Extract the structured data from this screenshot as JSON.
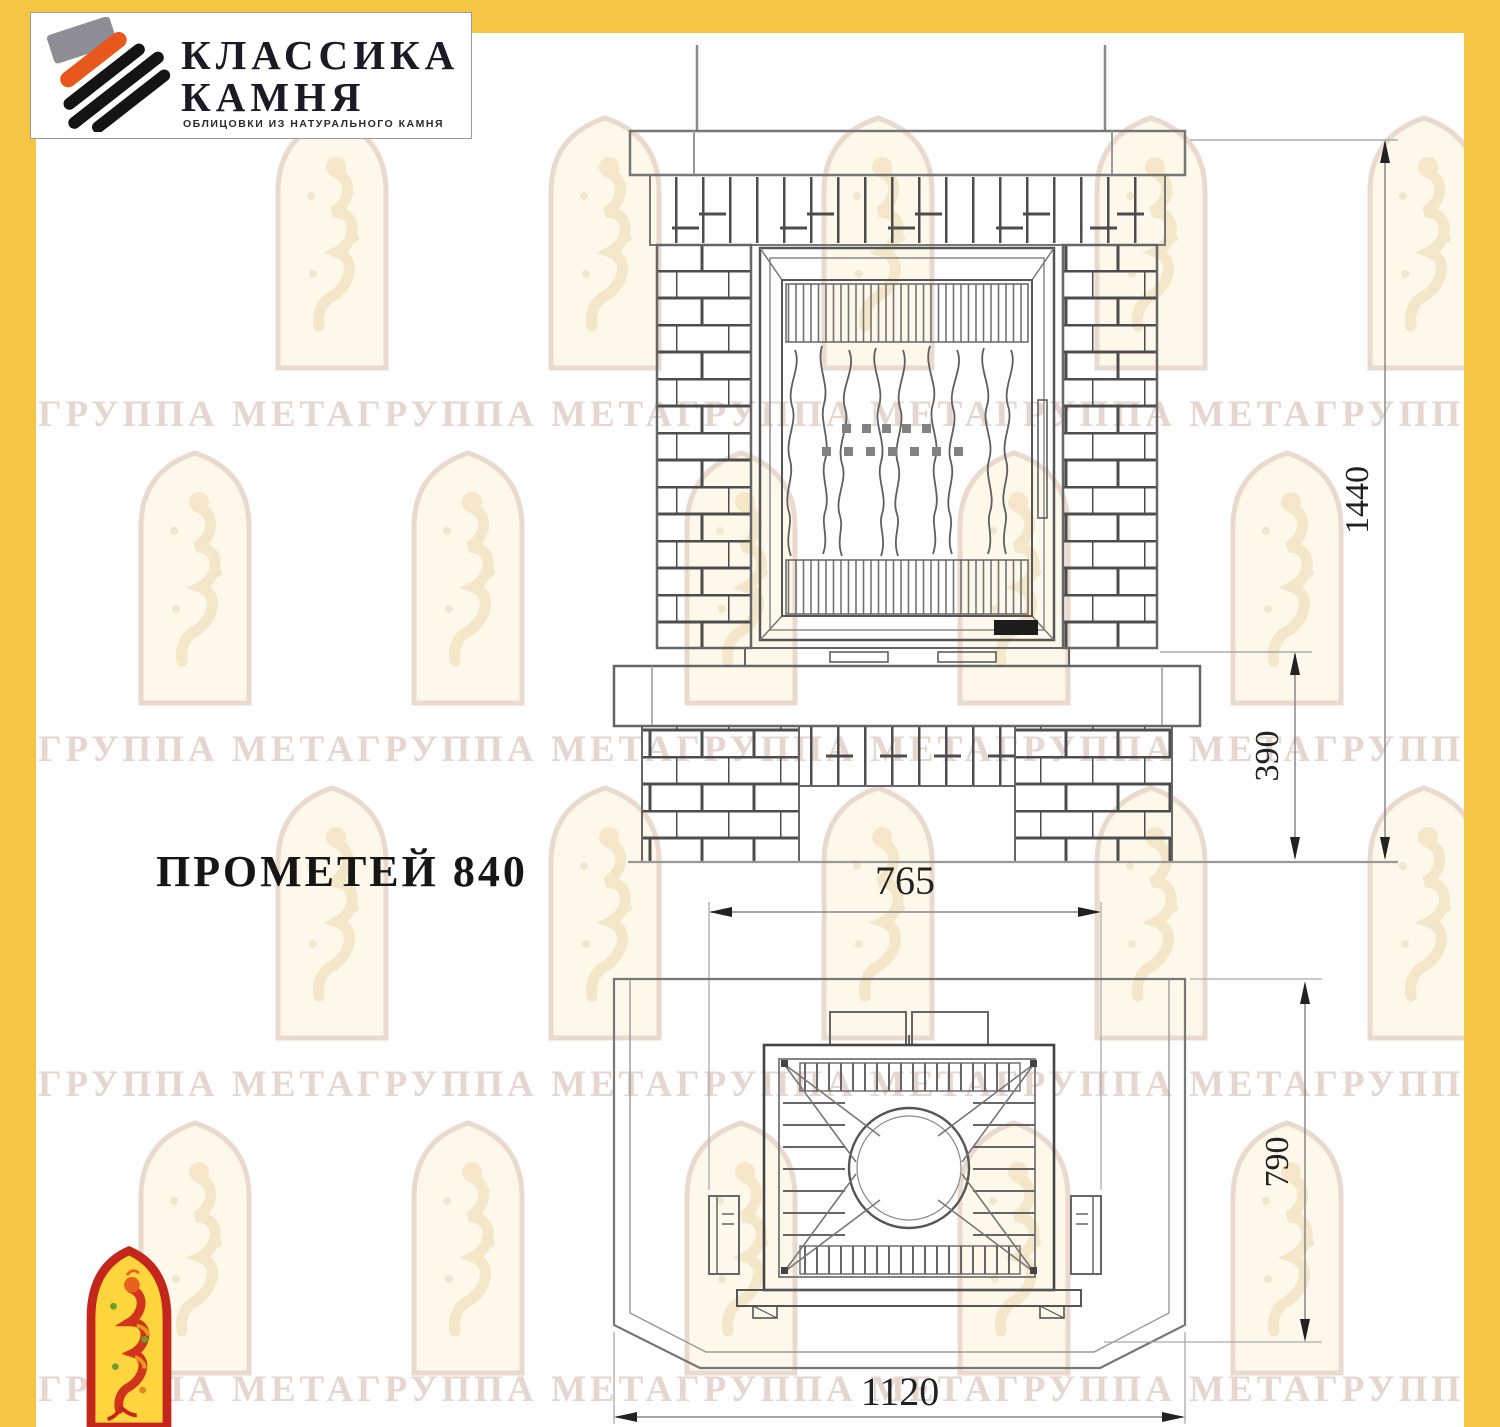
{
  "logo": {
    "name_line1": "КЛАССИКА",
    "name_line2": "КАМНЯ",
    "tagline": "ОБЛИЦОВКИ ИЗ НАТУРАЛЬНОГО КАМНЯ"
  },
  "product": {
    "title": "ПРОМЕТЕЙ 840"
  },
  "watermark": {
    "text": "ГРУППА МЕТАГРУППА МЕТАГРУППА МЕТАГРУППА МЕТАГРУППА МЕТАГРУППА МЕТА"
  },
  "drawing": {
    "front_view": {
      "dim_height_total": "1440",
      "dim_base_height": "390"
    },
    "plan_view": {
      "dim_insert_width": "765",
      "dim_depth": "790",
      "dim_total_width": "1120"
    }
  },
  "colors": {
    "frame_yellow": "#F5C544",
    "emblem_red": "#C3271B",
    "emblem_yellow": "#FFD53D",
    "logo_orange": "#E8581C"
  }
}
